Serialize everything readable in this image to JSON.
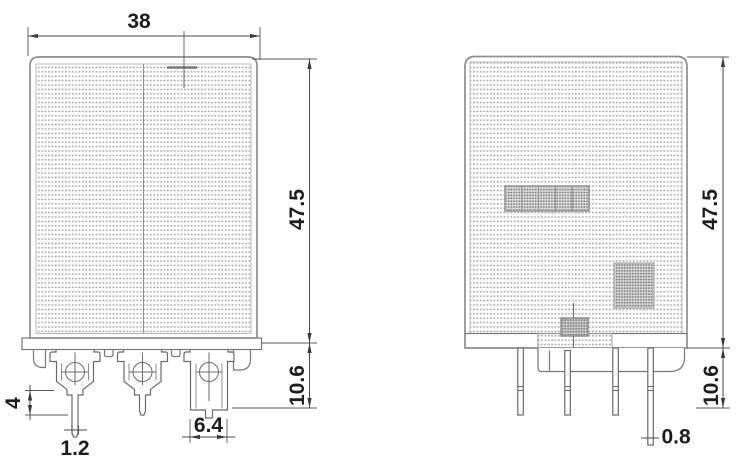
{
  "drawing": {
    "component": "Relay outline drawing (front and side views)",
    "views": {
      "front": {
        "dim_width": "38",
        "dim_height": "47.5",
        "dim_terminal_height": "10.6",
        "dim_pin_length": "4",
        "dim_pin_width": "1.2",
        "dim_blade_width": "6.4"
      },
      "side": {
        "dim_height": "47.5",
        "dim_terminal_height": "10.6",
        "dim_pin_thickness": "0.8"
      }
    },
    "colors": {
      "outline": "#8d8d8d",
      "detail": "#6a6a6a",
      "dimension": "#4a4a4a",
      "text": "#1e1e1e",
      "texture_dot": "#a2a2a2",
      "background": "#ffffff"
    }
  }
}
